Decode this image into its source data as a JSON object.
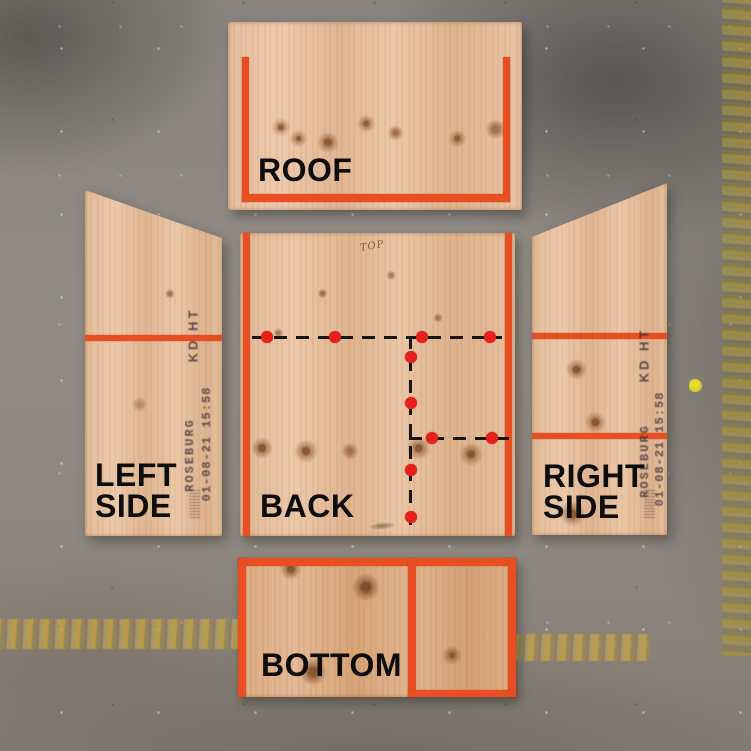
{
  "labels": {
    "roof": "ROOF",
    "left_line1": "LEFT",
    "left_line2": "SIDE",
    "back": "BACK",
    "right_line1": "RIGHT",
    "right_line2": "SIDE",
    "bottom": "BOTTOM"
  },
  "handwriting": {
    "top_note": "TOP"
  },
  "stamps": {
    "grade": "KD HT",
    "mill": "ROSEBURG",
    "datetime": "01-08-21 15:58"
  },
  "colors": {
    "tape_orange": "#e84e22",
    "dot_red": "#e8201c",
    "marker_black": "#161616",
    "label_black": "#0d0d0d",
    "floor_gray": "#8d8781",
    "yellow_line": "#c1a23c",
    "plywood_tan": "#e4bd9b"
  },
  "back_markings": {
    "lines": [
      {
        "dir": "h",
        "x": 12,
        "y": 103,
        "len": 250
      },
      {
        "dir": "v",
        "x": 169,
        "y": 103,
        "len": 198
      },
      {
        "dir": "h",
        "x": 169,
        "y": 204,
        "len": 100
      }
    ],
    "dots": [
      {
        "x": 27,
        "y": 104
      },
      {
        "x": 95,
        "y": 104
      },
      {
        "x": 182,
        "y": 104
      },
      {
        "x": 250,
        "y": 104
      },
      {
        "x": 171,
        "y": 124
      },
      {
        "x": 171,
        "y": 170
      },
      {
        "x": 171,
        "y": 237
      },
      {
        "x": 171,
        "y": 284
      },
      {
        "x": 192,
        "y": 205
      },
      {
        "x": 252,
        "y": 205
      }
    ]
  }
}
